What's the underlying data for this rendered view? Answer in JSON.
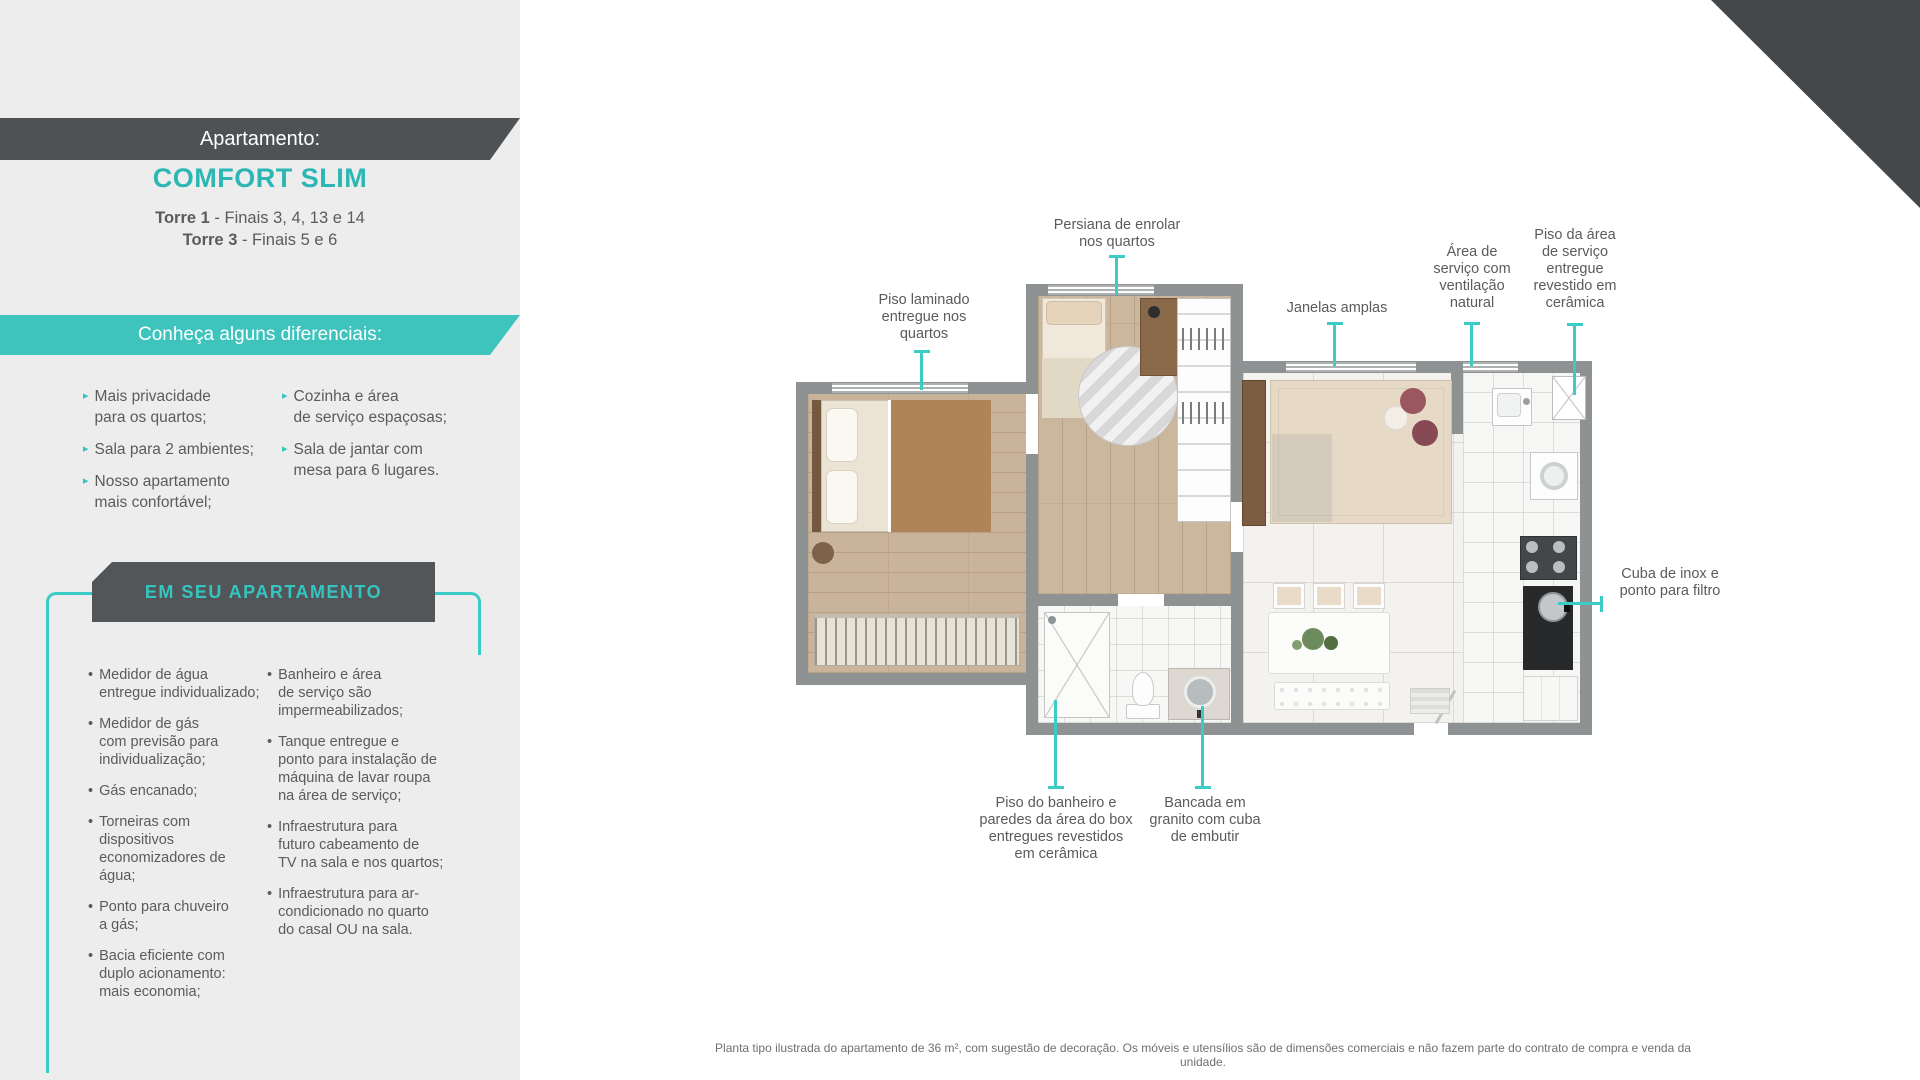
{
  "colors": {
    "accent_teal": "#35c5c0",
    "ribbon_teal": "#3fc3bd",
    "dark_gray": "#4e5254",
    "panel_gray": "#ededee",
    "callout_line": "#3bcdc5",
    "text_gray": "#5a5b5d"
  },
  "icons": {
    "arrow_bullet": "▸",
    "dot_bullet": "•"
  },
  "sidebar": {
    "ribbon_label": "Apartamento:",
    "title": "COMFORT SLIM",
    "towers": [
      {
        "name": "Torre 1",
        "info": " - Finais 3, 4, 13 e 14"
      },
      {
        "name": "Torre 3",
        "info": " - Finais 5 e 6"
      }
    ],
    "differentials": {
      "heading": "Conheça alguns diferenciais:",
      "left": [
        "Mais privacidade\npara os quartos;",
        "Sala para 2 ambientes;",
        "Nosso apartamento\nmais confortável;"
      ],
      "right": [
        "Cozinha e área\nde serviço espaçosas;",
        "Sala de jantar com\nmesa para 6 lugares."
      ]
    },
    "features": {
      "heading": "EM SEU APARTAMENTO",
      "left": [
        "Medidor de água\nentregue individualizado;",
        "Medidor de gás\ncom previsão para\nindividualização;",
        "Gás encanado;",
        "Torneiras com dispositivos\neconomizadores de água;",
        "Ponto para chuveiro\na gás;",
        "Bacia eficiente com\nduplo acionamento:\nmais economia;"
      ],
      "right": [
        "Banheiro e área\nde serviço são\nimpermeabilizados;",
        "Tanque entregue e\nponto para instalação de\nmáquina de lavar roupa\nna área de serviço;",
        "Infraestrutura para\nfuturo cabeamento de\nTV na sala e nos quartos;",
        "Infraestrutura para ar-\ncondicionado no quarto\ndo casal OU na sala."
      ]
    }
  },
  "floorplan": {
    "callouts": {
      "persiana": "Persiana de enrolar\nnos quartos",
      "piso_laminado": "Piso laminado\nentregue nos\nquartos",
      "janelas": "Janelas amplas",
      "area_servico": "Área de\nserviço com\nventilação\nnatural",
      "piso_area_servico": "Piso da área\nde serviço\nentregue\nrevestido em\ncerâmica",
      "cuba": "Cuba de inox e\nponto para filtro",
      "piso_banheiro": "Piso do banheiro e\nparedes da área do box\nentregues revestidos\nem cerâmica",
      "bancada": "Bancada em\ngranito com cuba\nde embutir"
    },
    "disclaimer": "Planta tipo ilustrada do apartamento de 36 m², com sugestão de decoração. Os móveis e utensílios são de dimensões comerciais e não fazem parte do contrato de compra e venda da unidade."
  }
}
